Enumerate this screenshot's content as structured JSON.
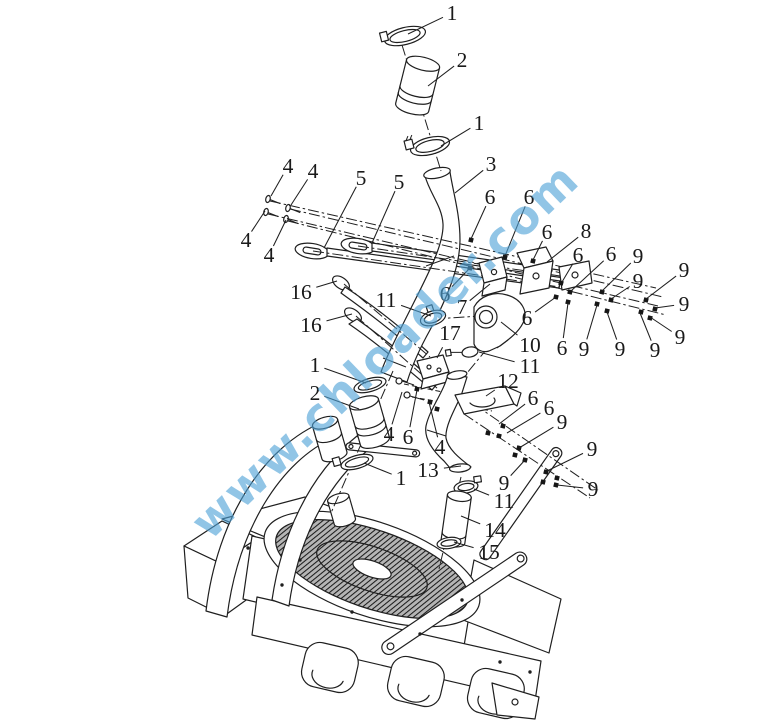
{
  "image": {
    "width": 777,
    "height": 723,
    "background": "#ffffff",
    "line_color": "#1f1f1f"
  },
  "watermark": {
    "text": "www.chloader.com",
    "color": "#4fa3d8",
    "opacity": 0.62,
    "rotation_deg": -44,
    "font_size": 46,
    "center_x": 396,
    "center_y": 362
  },
  "callouts": [
    {
      "n": "1",
      "x": 452,
      "y": 13,
      "tx": 408,
      "ty": 34
    },
    {
      "n": "2",
      "x": 462,
      "y": 60,
      "tx": 428,
      "ty": 86
    },
    {
      "n": "1",
      "x": 479,
      "y": 123,
      "tx": 441,
      "ty": 146
    },
    {
      "n": "3",
      "x": 491,
      "y": 164,
      "tx": 455,
      "ty": 193
    },
    {
      "n": "4",
      "x": 288,
      "y": 166,
      "tx": 271,
      "ty": 196
    },
    {
      "n": "4",
      "x": 313,
      "y": 171,
      "tx": 291,
      "ty": 205
    },
    {
      "n": "5",
      "x": 361,
      "y": 178,
      "tx": 324,
      "ty": 248
    },
    {
      "n": "5",
      "x": 399,
      "y": 182,
      "tx": 372,
      "ty": 243
    },
    {
      "n": "6",
      "x": 490,
      "y": 197,
      "tx": 471,
      "ty": 239
    },
    {
      "n": "6",
      "x": 529,
      "y": 197,
      "tx": 505,
      "ty": 256
    },
    {
      "n": "4",
      "x": 246,
      "y": 240,
      "tx": 265,
      "ty": 211
    },
    {
      "n": "4",
      "x": 269,
      "y": 255,
      "tx": 286,
      "ty": 220
    },
    {
      "n": "6",
      "x": 547,
      "y": 232,
      "tx": 533,
      "ty": 260
    },
    {
      "n": "8",
      "x": 586,
      "y": 231,
      "tx": 547,
      "ty": 262
    },
    {
      "n": "6",
      "x": 578,
      "y": 255,
      "tx": 562,
      "ty": 282
    },
    {
      "n": "6",
      "x": 611,
      "y": 254,
      "tx": 571,
      "ty": 291
    },
    {
      "n": "9",
      "x": 638,
      "y": 256,
      "tx": 602,
      "ty": 291
    },
    {
      "n": "9",
      "x": 638,
      "y": 281,
      "tx": 611,
      "ty": 299
    },
    {
      "n": "9",
      "x": 684,
      "y": 270,
      "tx": 646,
      "ty": 299
    },
    {
      "n": "9",
      "x": 684,
      "y": 304,
      "tx": 655,
      "ty": 308
    },
    {
      "n": "9",
      "x": 680,
      "y": 337,
      "tx": 650,
      "ty": 317
    },
    {
      "n": "16",
      "x": 301,
      "y": 292,
      "tx": 337,
      "ty": 281
    },
    {
      "n": "16",
      "x": 311,
      "y": 325,
      "tx": 352,
      "ty": 314
    },
    {
      "n": "11",
      "x": 386,
      "y": 300,
      "tx": 431,
      "ty": 316
    },
    {
      "n": "6",
      "x": 445,
      "y": 294,
      "tx": 470,
      "ty": 268
    },
    {
      "n": "7",
      "x": 462,
      "y": 307,
      "tx": 490,
      "ty": 284
    },
    {
      "n": "17",
      "x": 450,
      "y": 333,
      "tx": 437,
      "ty": 358
    },
    {
      "n": "10",
      "x": 530,
      "y": 345,
      "tx": 501,
      "ty": 322
    },
    {
      "n": "6",
      "x": 527,
      "y": 318,
      "tx": 556,
      "ty": 297
    },
    {
      "n": "6",
      "x": 562,
      "y": 348,
      "tx": 568,
      "ty": 303
    },
    {
      "n": "9",
      "x": 584,
      "y": 349,
      "tx": 597,
      "ty": 305
    },
    {
      "n": "9",
      "x": 620,
      "y": 349,
      "tx": 607,
      "ty": 312
    },
    {
      "n": "9",
      "x": 655,
      "y": 350,
      "tx": 640,
      "ty": 313
    },
    {
      "n": "11",
      "x": 530,
      "y": 366,
      "tx": 479,
      "ty": 352
    },
    {
      "n": "1",
      "x": 315,
      "y": 365,
      "tx": 366,
      "ty": 383
    },
    {
      "n": "2",
      "x": 315,
      "y": 393,
      "tx": 359,
      "ty": 409
    },
    {
      "n": "12",
      "x": 508,
      "y": 381,
      "tx": 486,
      "ty": 396
    },
    {
      "n": "6",
      "x": 533,
      "y": 398,
      "tx": 499,
      "ty": 424
    },
    {
      "n": "6",
      "x": 549,
      "y": 408,
      "tx": 507,
      "ty": 433
    },
    {
      "n": "9",
      "x": 562,
      "y": 422,
      "tx": 519,
      "ty": 448
    },
    {
      "n": "9",
      "x": 592,
      "y": 449,
      "tx": 547,
      "ty": 471
    },
    {
      "n": "4",
      "x": 389,
      "y": 434,
      "tx": 402,
      "ty": 392
    },
    {
      "n": "6",
      "x": 408,
      "y": 437,
      "tx": 417,
      "ty": 390
    },
    {
      "n": "4",
      "x": 440,
      "y": 447,
      "tx": 429,
      "ty": 402
    },
    {
      "n": "13",
      "x": 428,
      "y": 470,
      "tx": 461,
      "ty": 466
    },
    {
      "n": "1",
      "x": 401,
      "y": 478,
      "tx": 364,
      "ty": 463
    },
    {
      "n": "9",
      "x": 504,
      "y": 483,
      "tx": 525,
      "ty": 460
    },
    {
      "n": "9",
      "x": 593,
      "y": 489,
      "tx": 557,
      "ty": 485
    },
    {
      "n": "11",
      "x": 504,
      "y": 501,
      "tx": 474,
      "ty": 489
    },
    {
      "n": "14",
      "x": 495,
      "y": 530,
      "tx": 461,
      "ty": 516
    },
    {
      "n": "15",
      "x": 489,
      "y": 552,
      "tx": 454,
      "ty": 542
    }
  ],
  "fastener_dots": [
    [
      561,
      283
    ],
    [
      570,
      292
    ],
    [
      602,
      292
    ],
    [
      611,
      300
    ],
    [
      646,
      300
    ],
    [
      655,
      309
    ],
    [
      568,
      302
    ],
    [
      597,
      304
    ],
    [
      607,
      311
    ],
    [
      641,
      312
    ],
    [
      650,
      318
    ],
    [
      471,
      240
    ],
    [
      505,
      257
    ],
    [
      470,
      268
    ],
    [
      556,
      297
    ],
    [
      533,
      261
    ],
    [
      417,
      389
    ],
    [
      430,
      402
    ],
    [
      437,
      409
    ],
    [
      488,
      433
    ],
    [
      503,
      426
    ],
    [
      499,
      436
    ],
    [
      515,
      455
    ],
    [
      525,
      460
    ],
    [
      546,
      472
    ],
    [
      557,
      478
    ],
    [
      543,
      482
    ],
    [
      556,
      485
    ],
    [
      519,
      448
    ]
  ]
}
